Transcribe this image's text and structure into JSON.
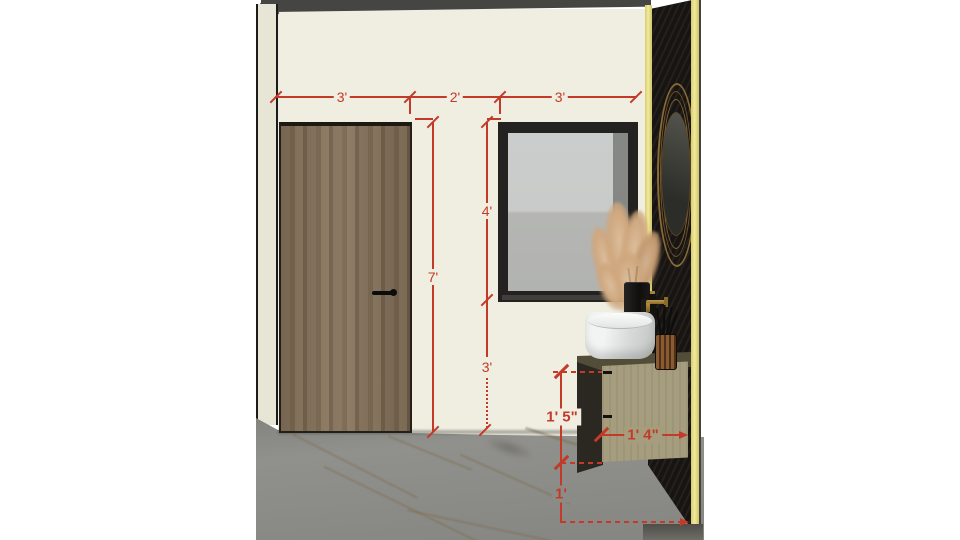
{
  "scene": {
    "objects": [
      "door",
      "window",
      "round-mirror",
      "accent-black-wall",
      "led-strip",
      "floating-vanity",
      "vessel-sink",
      "pampas-grass",
      "brush-cup",
      "marble-floor"
    ]
  },
  "dimensions": {
    "top_row": [
      {
        "id": "corner-to-door",
        "label": "3'"
      },
      {
        "id": "door-to-window",
        "label": "2'"
      },
      {
        "id": "window-width",
        "label": "3'"
      }
    ],
    "door_height": {
      "label": "7'"
    },
    "window_height": {
      "label": "4'"
    },
    "window_sill_to_floor": {
      "label": "3'"
    },
    "vanity_height": {
      "label": "1' 5\""
    },
    "vanity_width": {
      "label": "1' 4\""
    },
    "vanity_to_floor": {
      "label": "1'"
    }
  },
  "colors": {
    "dimension_red": "#c43a29",
    "wall_cream": "#efeee1",
    "side_wall": "#e7e5d6",
    "ceiling_gray": "#454543",
    "floor_gray": "#8b8b88",
    "accent_yellow": "#eee48f",
    "black_wall": "#171411",
    "door_wood": "#82705a",
    "vanity_khaki": "#a59d7d",
    "counter_olive": "#524d39",
    "mirror_gold": "#8a6a35"
  }
}
